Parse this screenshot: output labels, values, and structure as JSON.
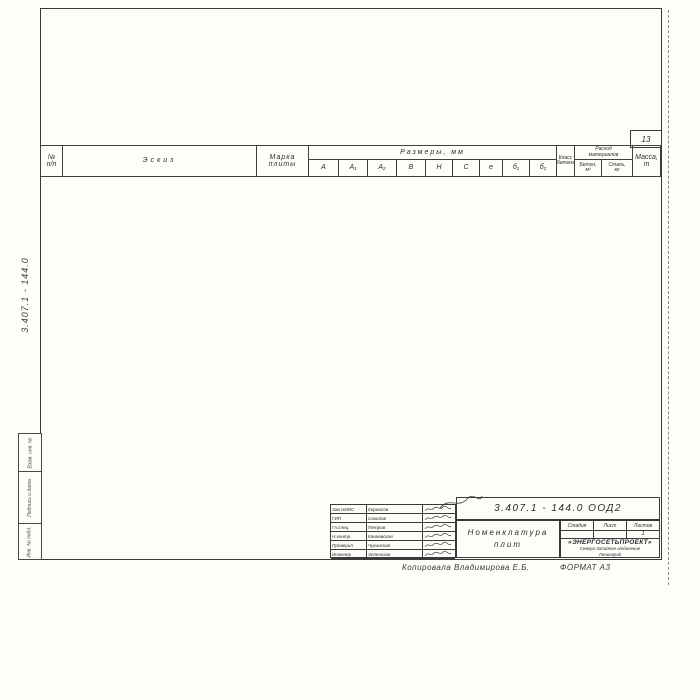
{
  "sheet": {
    "page_number": "13",
    "doc_code_vertical": "3.407.1 - 144.0",
    "copy_note": "Копировала Владимирова Е.Б.",
    "format_note": "ФОРМАТ А3",
    "side_stamps": [
      "Взам. инв. №",
      "Подпись и дата",
      "Инв. № подл."
    ]
  },
  "table": {
    "header": {
      "num": "№",
      "num_sub": "п/п",
      "sketch": "Эскиз",
      "mark1": "Марка",
      "mark2": "плиты",
      "dims": "Размеры, мм",
      "cols": [
        "А",
        "А₁",
        "А₂",
        "В",
        "Н",
        "С",
        "е",
        "б₁",
        "б₂"
      ],
      "class1": "Класс",
      "class2": "бетона",
      "cons1": "Расход",
      "cons2": "материалов",
      "concrete1": "Бетон,",
      "concrete2": "м³",
      "steel1": "Сталь,",
      "steel2": "кг",
      "mass1": "Масса,",
      "mass2": "т"
    },
    "class_value": "В30",
    "rows": [
      {
        "n": "1",
        "mark": "П1,5×1",
        "a": "1000",
        "a1": "500",
        "a2": "500",
        "b1": "",
        "b2": "390",
        "concrete": "0,28",
        "steel": "44,1",
        "mass": "0,7"
      },
      {
        "n": "2",
        "mark": "П1,5×1,5",
        "a": "1500",
        "a1": "750",
        "a2": "750",
        "b1": "200",
        "b2": "290",
        "concrete": "0,40",
        "steel": "48,1",
        "mass": "1,0"
      },
      {
        "n": "3",
        "mark": "П1,5×2,2",
        "a": "2200",
        "a1": "1100",
        "a2": "1100",
        "b1": "",
        "b2": "160",
        "concrete": "0,57",
        "steel": "68,9",
        "mass": "1,43"
      },
      {
        "n": "4",
        "mark": "П2×2,1",
        "a": "2100",
        "a1": "1050",
        "a2": "1050",
        "b1": "400",
        "b2": "400",
        "concrete": "0,84",
        "steel": "101,9",
        "mass": "2,1"
      },
      {
        "n": "5",
        "mark": "П2×2,8",
        "a": "2800",
        "a1": "1400",
        "a2": "1400",
        "b1": "320",
        "b2": "320",
        "concrete": "1,05",
        "steel": "123,8",
        "mass": "2,63"
      },
      {
        "n": "6",
        "mark": "П2×3,5",
        "a": "3500",
        "a1": "1750",
        "a2": "1750",
        "b1": "250",
        "b2": "250",
        "concrete": "1,37",
        "steel": "225,5",
        "mass": "3,42"
      },
      {
        "n": "7",
        "mark": "П2,7×3,5",
        "a": "3500",
        "a1": "1750",
        "a2": "1750",
        "b1": "370",
        "b2": "370",
        "concrete": "2,0",
        "steel": "115,6",
        "mass": "5,0"
      },
      {
        "n": "8",
        "mark": "П2,7×4,5",
        "a": "4500",
        "a1": "2250",
        "a2": "2250",
        "b1": "270",
        "b2": "270",
        "concrete": "2,52",
        "steel": "155,4",
        "mass": "6,3"
      },
      {
        "n": "9",
        "mark": "П2×1,6-А",
        "a": "1600",
        "a1": "1050",
        "a2": "550",
        "b1": "400",
        "b2": "500",
        "concrete": "0,66",
        "steel": "251,4",
        "mass": "1,65"
      },
      {
        "n": "10",
        "mark": "П2×2,3-А",
        "a": "2300",
        "a1": "1400",
        "a2": "900",
        "b1": "325",
        "b2": "430",
        "concrete": "0,96",
        "steel": "328,0",
        "mass": "2,4"
      },
      {
        "n": "11",
        "mark": "П2×3,0-А",
        "a": "3000",
        "a1": "1750",
        "a2": "1250",
        "b1": "250",
        "b2": "355",
        "concrete": "1,21",
        "steel": "263,4",
        "mass": "3,0"
      },
      {
        "n": "12",
        "mark": "П2×3,6-А",
        "a": "3600",
        "a1": "2050",
        "a2": "1550",
        "b1": "190",
        "b2": "300",
        "concrete": "1,43",
        "steel": "250,1",
        "mass": "3,58"
      },
      {
        "n": "13",
        "mark": "П2,7×2,7-А",
        "a": "2700",
        "a1": "1750",
        "a2": "950",
        "b1": "385",
        "b2": "520",
        "concrete": "1,62",
        "steel": "298,8",
        "mass": "4,15"
      },
      {
        "n": "14",
        "mark": "П2,7×3,5-А",
        "a": "3500",
        "a1": "2000",
        "a2": "1500",
        "b1": "320",
        "b2": "415",
        "concrete": "2,1",
        "steel": "352,8",
        "mass": "5,25"
      },
      {
        "n": "15",
        "mark": "П2,7×4,2-А",
        "a": "4200",
        "a1": "2500",
        "a2": "1700",
        "b1": "220",
        "b2": "375",
        "concrete": "2,42",
        "steel": "387,3",
        "mass": "6,05"
      },
      {
        "n": "16",
        "mark": "П2,7×4,5-А",
        "a": "4500",
        "a1": "2500",
        "a2": "2000",
        "b1": "220",
        "b2": "320",
        "concrete": "2,6",
        "steel": "548,5",
        "mass": "6,5"
      },
      {
        "n": "17",
        "mark": "П2×3,6-А5",
        "a": "3600",
        "a1": "2050",
        "a2": "1550",
        "b1": "190",
        "b2": "300",
        "concrete": "1,43",
        "steel": "480,3",
        "mass": "3,58"
      },
      {
        "n": "18",
        "mark": "П2,7×3,5-А5",
        "a": "3500",
        "a1": "2000",
        "a2": "1500",
        "b1": "320",
        "b2": "415",
        "concrete": "2,1",
        "steel": "334,5",
        "mass": "5,25"
      },
      {
        "n": "19",
        "mark": "П2,7×4,5-А5",
        "a": "4500",
        "a1": "2500",
        "a2": "2000",
        "b1": "220",
        "b2": "320",
        "concrete": "2,6",
        "steel": "423,2",
        "mass": "6,5"
      }
    ],
    "merged": {
      "b_h": [
        {
          "start": 1,
          "span": 3,
          "b": "1500",
          "h": "400"
        },
        {
          "start": 4,
          "span": 3,
          "b": "2000",
          "h": "500"
        },
        {
          "start": 7,
          "span": 2,
          "b": "2700",
          "h": "600"
        },
        {
          "start": 9,
          "span": 4,
          "b": "2000",
          "h": "500"
        },
        {
          "start": 13,
          "span": 4,
          "b": "2700",
          "h": "600"
        },
        {
          "start": 17,
          "span": 1,
          "b": "2000",
          "h": "500"
        },
        {
          "start": 18,
          "span": 2,
          "b": "2700",
          "h": "600"
        }
      ],
      "c_e": [
        {
          "start": 1,
          "span": 8,
          "c": "800",
          "e": "610"
        },
        {
          "start": 9,
          "span": 11,
          "c": "1050",
          "e": "610"
        }
      ]
    }
  },
  "sketch_labels": {
    "c": "С",
    "e": "е",
    "a1": "А₁",
    "a2": "А₂",
    "a": "А",
    "b": "В",
    "b1": "б₁",
    "b2": "б₂",
    "h": "Н",
    "dim100": "100"
  },
  "titleblock": {
    "doc_number": "3.407.1 - 144.0  ООД2",
    "title1": "Номенклатура",
    "title2": "плит",
    "stage_label": "Стадия",
    "sheet_label": "Лист",
    "sheets_label": "Листов",
    "stage_value": "",
    "sheet_value": "",
    "sheets_value": "1",
    "org_name": "«ЭНЕРГОСЕТЬПРОЕКТ»",
    "org_branch": "Северо-Западное отделение",
    "org_city": "Ленинград",
    "signers": [
      {
        "role": "Зав.НИИС",
        "name": "Кирносов"
      },
      {
        "role": "ГИП",
        "name": "Соколов"
      },
      {
        "role": "Гл.спец.",
        "name": "Петров"
      },
      {
        "role": "Н.контр.",
        "name": "Канаевская"
      },
      {
        "role": "Проверил",
        "name": "Чукинская"
      },
      {
        "role": "Инженер",
        "name": "Зеленская"
      }
    ]
  }
}
